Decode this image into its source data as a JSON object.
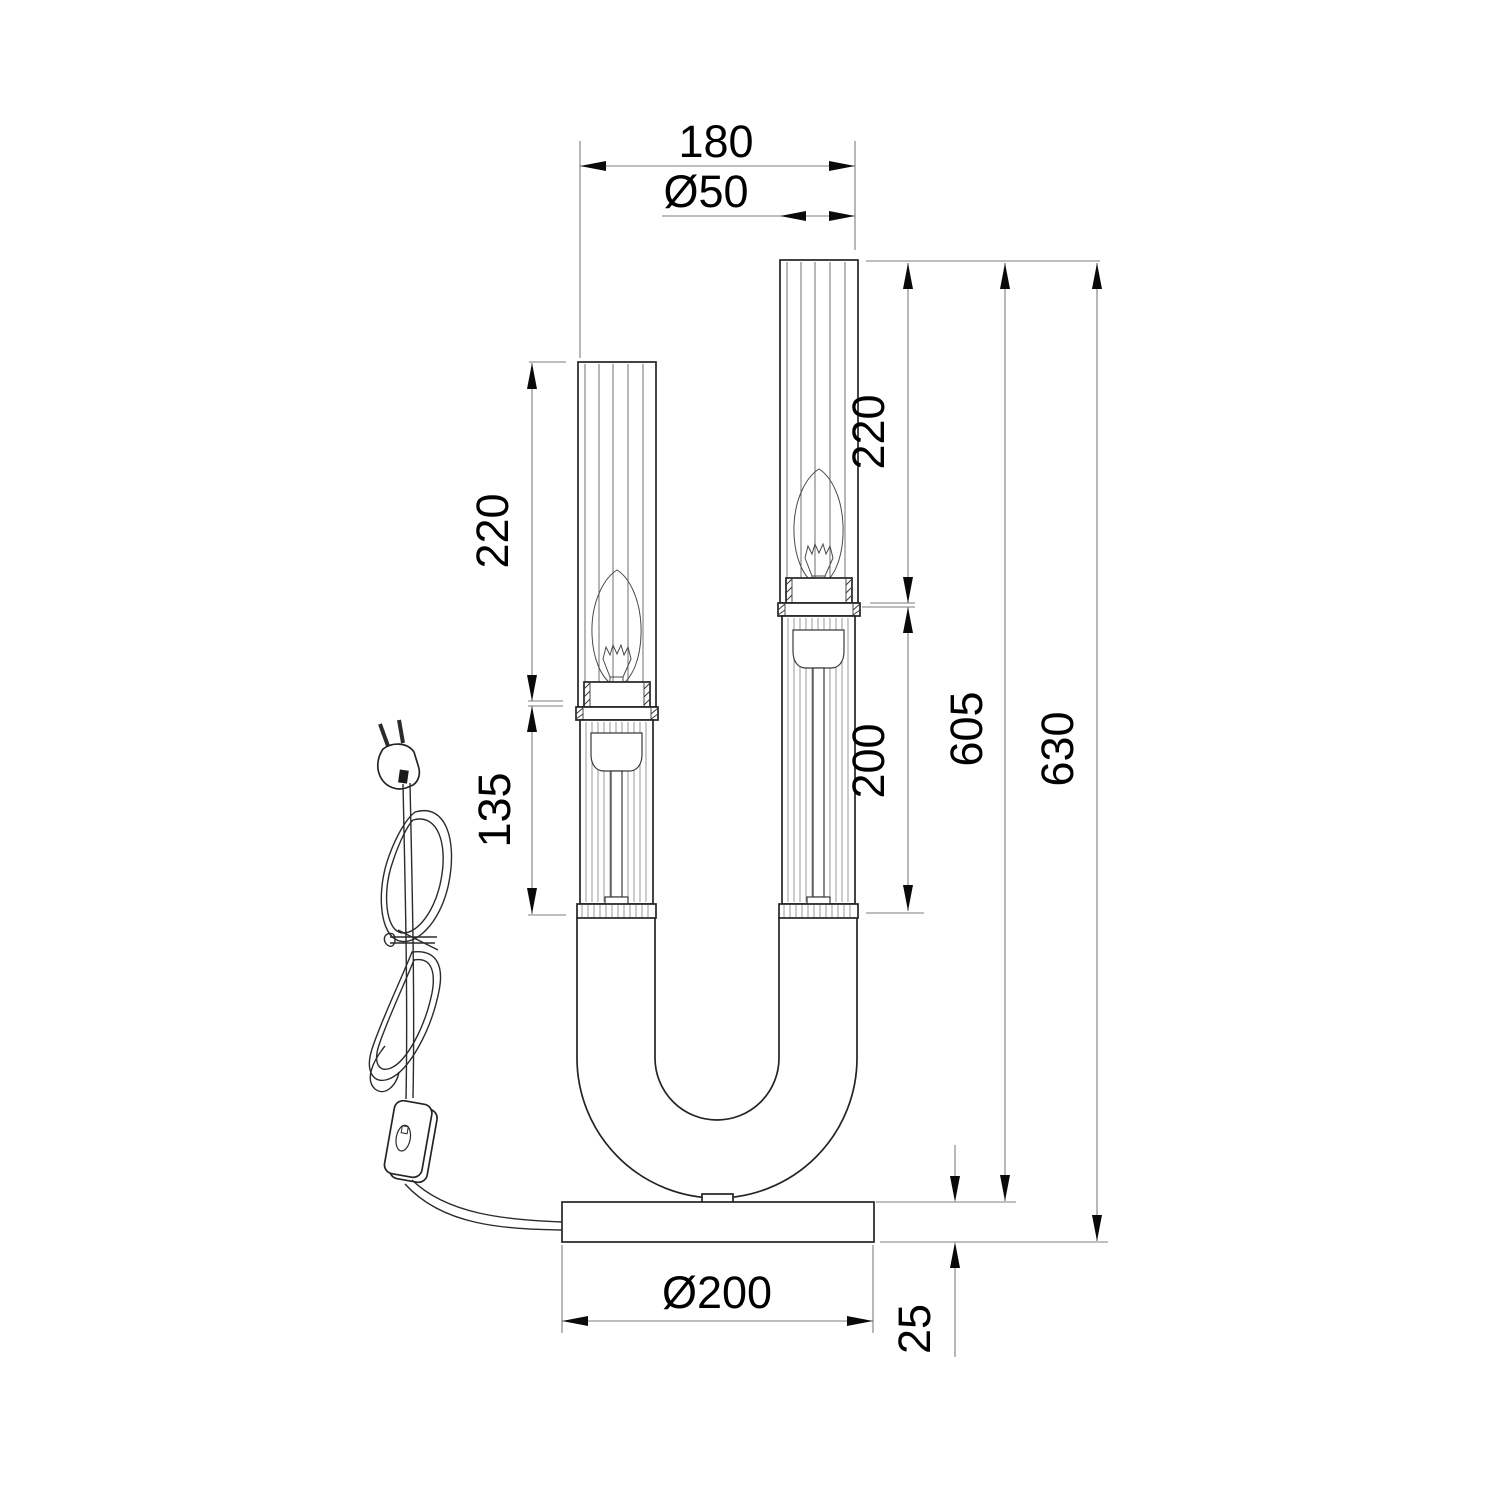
{
  "drawing": {
    "kind": "lamp technical dimension drawing",
    "colors": {
      "background": "#ffffff",
      "object_line": "#242424",
      "dimension_line": "#7d7d7d",
      "arrow": "#0a0a0a",
      "text": "#000000"
    },
    "dimensions": {
      "overall_width": "180",
      "shade_diameter": "Ø50",
      "left_shade_height": "220",
      "left_column_height": "135",
      "right_shade_height": "220",
      "right_column_height": "200",
      "height_to_base_top": "605",
      "overall_height": "630",
      "base_diameter": "Ø200",
      "base_thickness": "25"
    }
  }
}
